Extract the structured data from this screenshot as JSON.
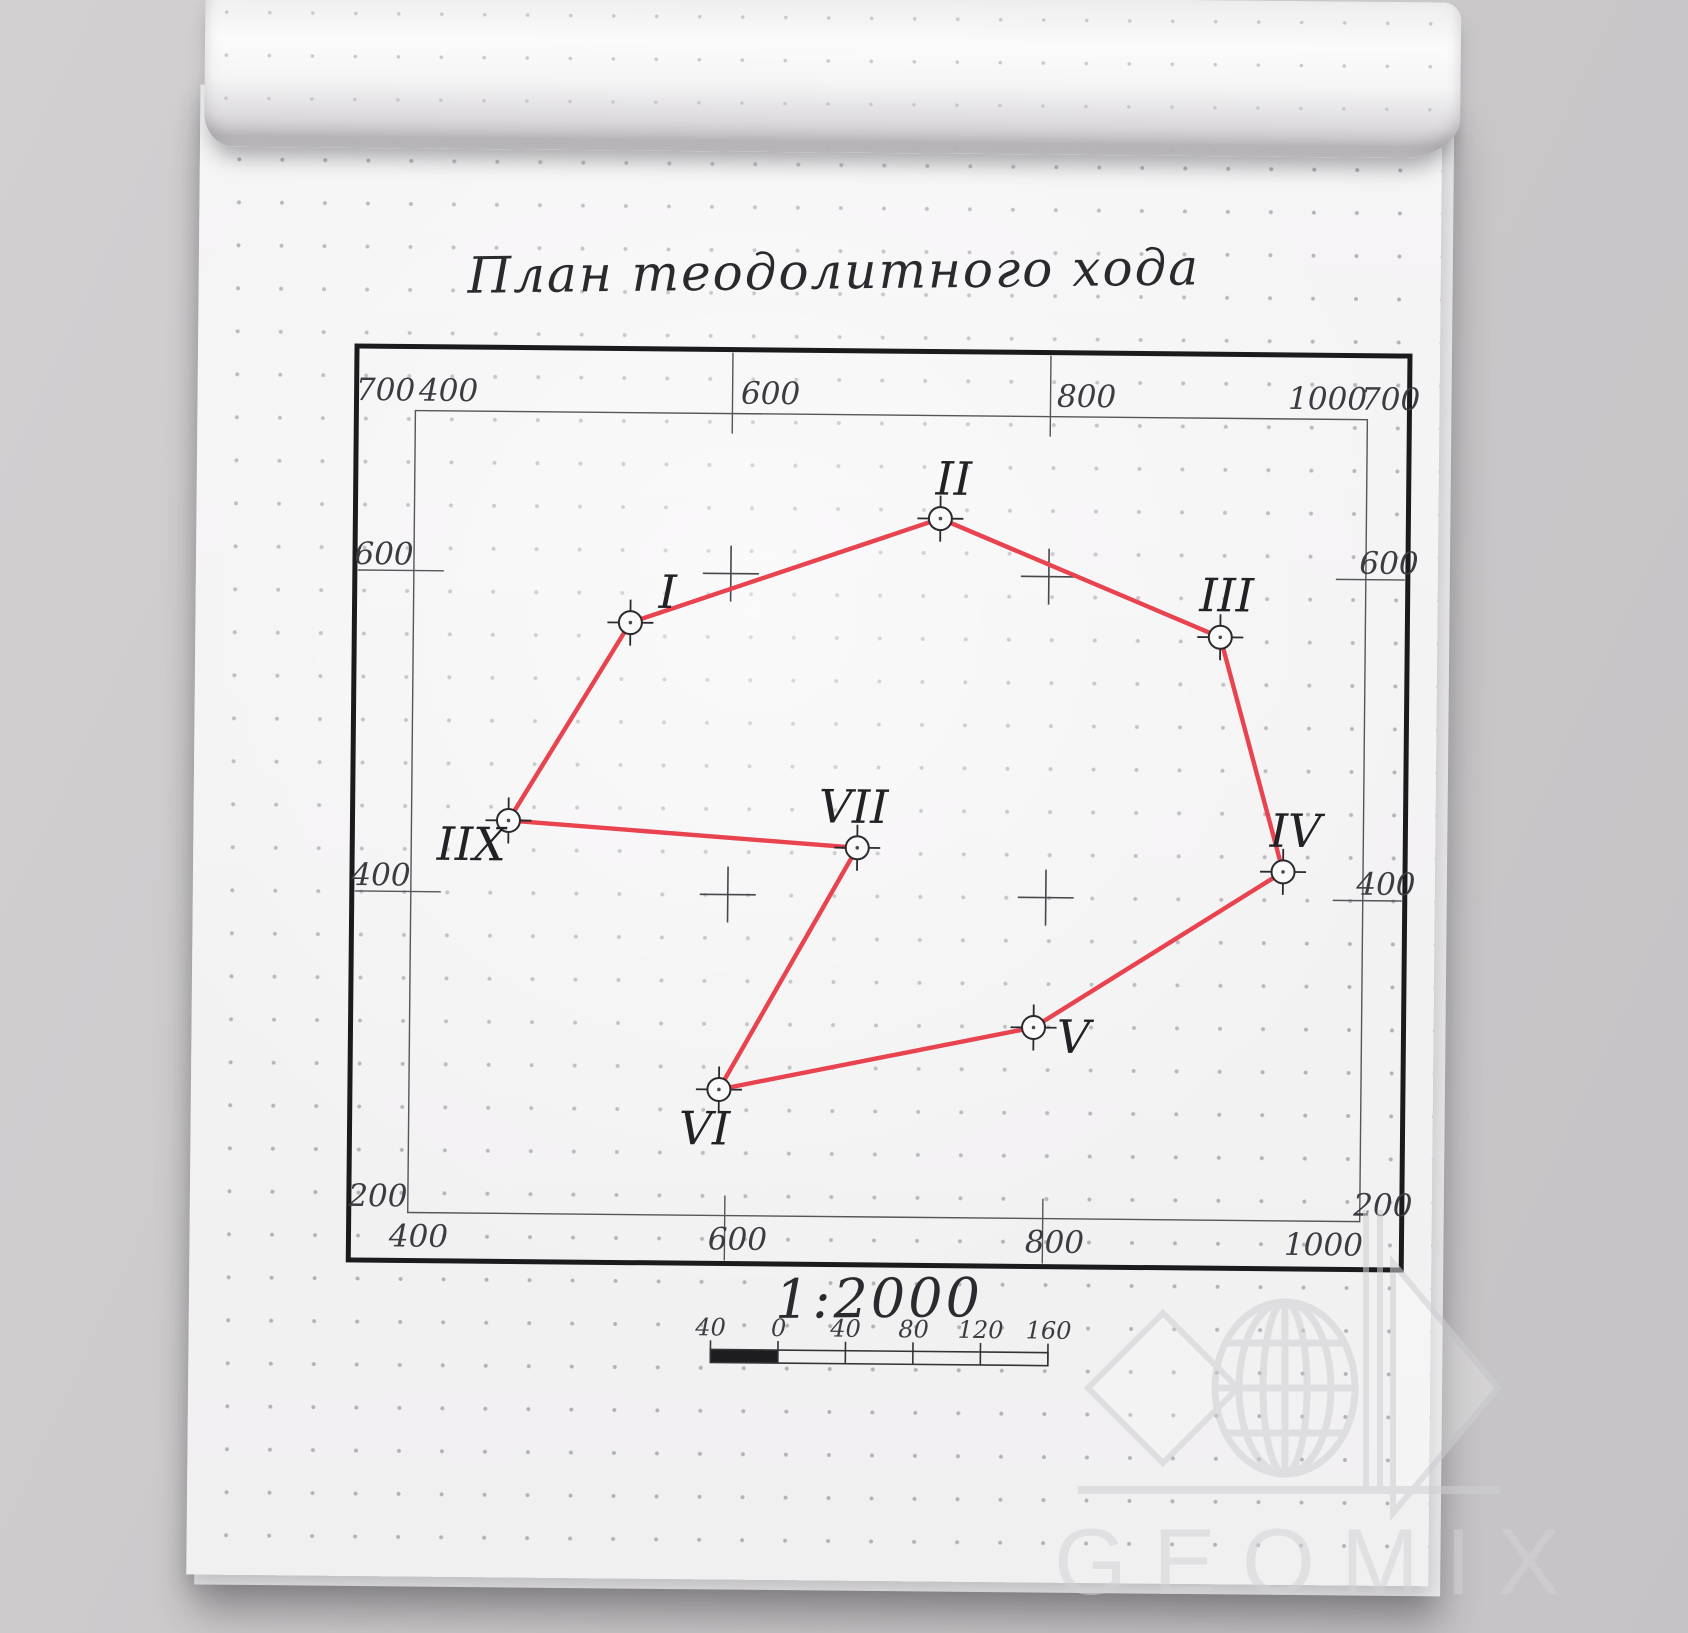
{
  "plan": {
    "title": "План теодолитного хода",
    "scale_text": "1:2000",
    "colors": {
      "traverse": "#e8434e",
      "ink": "#2a2a2e",
      "frame": "#1b1b1e",
      "grid": "#55555a",
      "cross": "#47474c"
    },
    "frame": {
      "outer": {
        "x": 357,
        "y": 346,
        "w": 1053,
        "h": 914
      },
      "inner": {
        "x": 416,
        "y": 410,
        "w": 952,
        "h": 802
      }
    },
    "grid": {
      "v_lines_x": [
        733,
        1051
      ],
      "h_lines_y": [
        570,
        891
      ],
      "top_labels": [
        {
          "text": "700",
          "x": 386
        },
        {
          "text": "400",
          "x": 449
        },
        {
          "text": "600",
          "x": 771
        },
        {
          "text": "800",
          "x": 1087
        },
        {
          "text": "1000",
          "x": 1328
        },
        {
          "text": "700",
          "x": 1391
        }
      ],
      "bottom_labels": [
        {
          "text": "400",
          "x": 427
        },
        {
          "text": "600",
          "x": 746
        },
        {
          "text": "800",
          "x": 1063
        },
        {
          "text": "1000",
          "x": 1332
        }
      ],
      "left_labels": [
        {
          "text": "600",
          "y": 570
        },
        {
          "text": "400",
          "y": 891
        },
        {
          "text": "200",
          "y": 1212
        }
      ],
      "right_labels": [
        {
          "text": "600",
          "y": 570
        },
        {
          "text": "400",
          "y": 891
        },
        {
          "text": "200",
          "y": 1212
        }
      ]
    },
    "points": [
      {
        "name": "I",
        "x": 633,
        "y": 620,
        "lx": 670,
        "ly": 605
      },
      {
        "name": "II",
        "x": 942,
        "y": 513,
        "lx": 955,
        "ly": 489
      },
      {
        "name": "III",
        "x": 1223,
        "y": 629,
        "lx": 1229,
        "ly": 603
      },
      {
        "name": "IV",
        "x": 1288,
        "y": 863,
        "lx": 1300,
        "ly": 838
      },
      {
        "name": "V",
        "x": 1040,
        "y": 1021,
        "lx": 1080,
        "ly": 1046
      },
      {
        "name": "VI",
        "x": 726,
        "y": 1086,
        "lx": 712,
        "ly": 1141
      },
      {
        "name": "VII",
        "x": 862,
        "y": 843,
        "lx": 858,
        "ly": 818
      },
      {
        "name": "IIX",
        "x": 513,
        "y": 819,
        "lx": 476,
        "ly": 859
      }
    ],
    "traverse_order": [
      "I",
      "II",
      "III",
      "IV",
      "V",
      "VI",
      "VII",
      "IIX"
    ],
    "scale_bar": {
      "x": 720,
      "y": 1346,
      "seg_w": 67.5,
      "segments": 5,
      "h": 13,
      "labels": [
        {
          "text": "40",
          "x": 720
        },
        {
          "text": "0",
          "x": 788
        },
        {
          "text": "40",
          "x": 855
        },
        {
          "text": "80",
          "x": 923
        },
        {
          "text": "120",
          "x": 990
        },
        {
          "text": "160",
          "x": 1058
        }
      ]
    }
  },
  "watermark": {
    "text": "GEOMIX"
  }
}
